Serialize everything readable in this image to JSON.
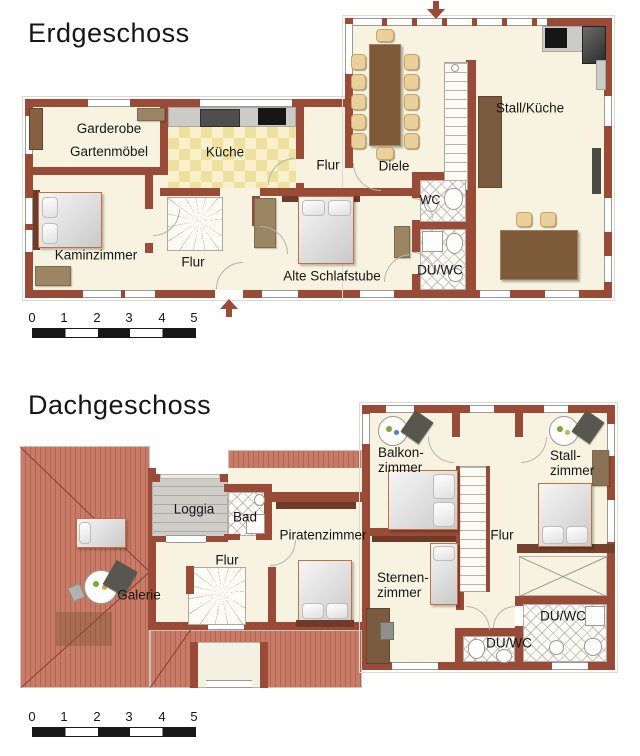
{
  "colors": {
    "wall": "#9a4b37",
    "wall_dark": "#6f3a28",
    "floor": "#f7f3e0",
    "roof": "#c87c68",
    "kitchen_tile": "#eee09e",
    "loggia_planks": "#cfcdc8",
    "scale_black": "#181818"
  },
  "erdgeschoss": {
    "title": "Erdgeschoss",
    "rooms": {
      "garderobe_line1": "Garderobe",
      "garderobe_line2": "Gartenmöbel",
      "kueche": "Küche",
      "flur_mitte": "Flur",
      "diele": "Diele",
      "stall_kueche": "Stall/Küche",
      "wc": "WC",
      "du_wc": "DU/WC",
      "kaminzimmer": "Kaminzimmer",
      "flur_sued": "Flur",
      "alte_schlafstube": "Alte Schlafstube"
    },
    "scale_ticks": [
      "0",
      "1",
      "2",
      "3",
      "4",
      "5"
    ]
  },
  "dachgeschoss": {
    "title": "Dachgeschoss",
    "rooms": {
      "loggia": "Loggia",
      "bad": "Bad",
      "piratenzimmer": "Piratenzimmer",
      "flur_west": "Flur",
      "galerie": "Galerie",
      "balkonzimmer_line1": "Balkon-",
      "balkonzimmer_line2": "zimmer",
      "stallzimmer_line1": "Stall-",
      "stallzimmer_line2": "zimmer",
      "flur_ost": "Flur",
      "sternenzimmer_line1": "Sternen-",
      "sternenzimmer_line2": "zimmer",
      "du_wc_gross": "DU/WC",
      "du_wc_klein": "DU/WC"
    },
    "scale_ticks": [
      "0",
      "1",
      "2",
      "3",
      "4",
      "5"
    ]
  }
}
